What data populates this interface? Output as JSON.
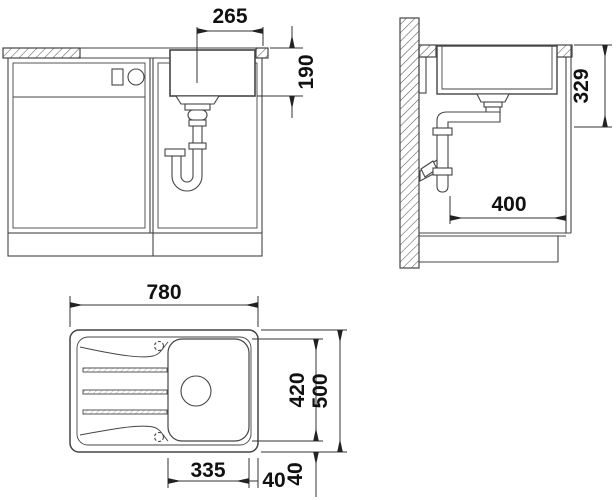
{
  "drawing": {
    "front_view": {
      "dim_drain_to_edge": "265",
      "dim_bowl_depth": "190"
    },
    "side_view": {
      "dim_top_to_outlet": "329",
      "dim_outlet_to_front": "400"
    },
    "plan_view": {
      "dim_overall_length": "780",
      "dim_bowl_length": "335",
      "dim_overall_width": "500",
      "dim_bowl_width": "420",
      "dim_edge_gap_right": "40",
      "dim_edge_gap_front": "40"
    }
  },
  "colors": {
    "line": "#444444",
    "dim_line": "#333333",
    "text": "#111111",
    "background": "#ffffff"
  }
}
